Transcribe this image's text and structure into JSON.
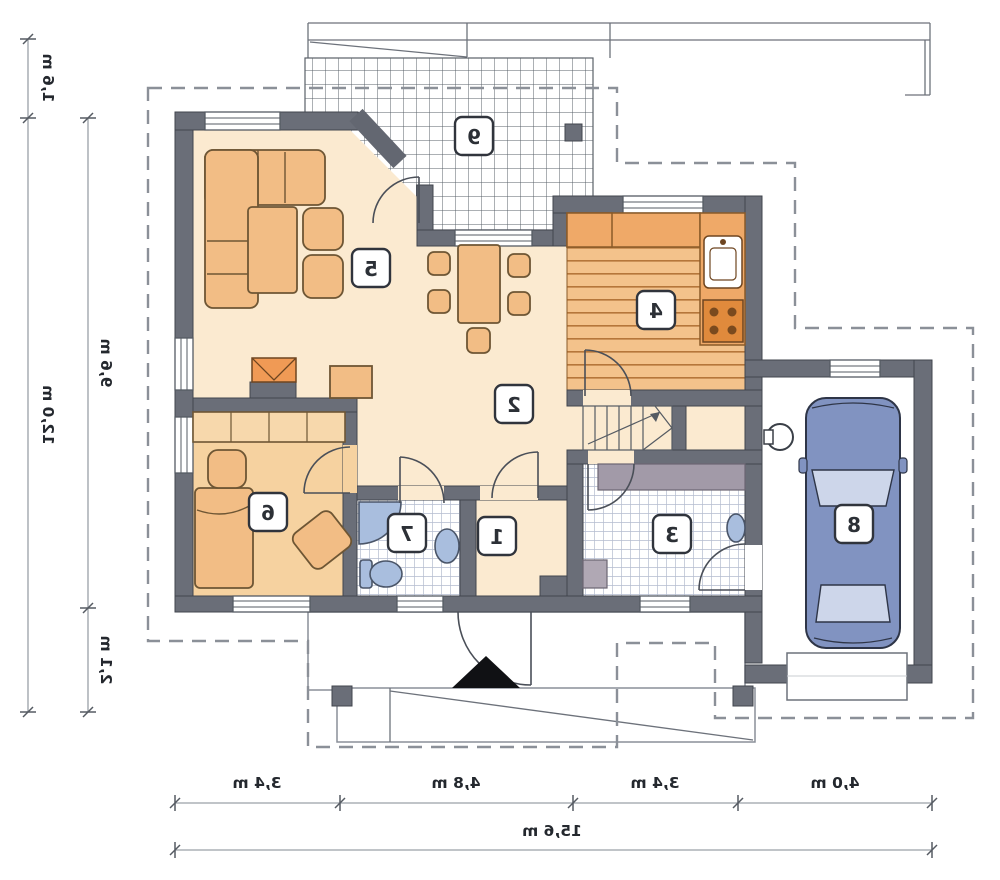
{
  "plan": {
    "rooms": [
      {
        "number": "1"
      },
      {
        "number": "2"
      },
      {
        "number": "3"
      },
      {
        "number": "4"
      },
      {
        "number": "5"
      },
      {
        "number": "6"
      },
      {
        "number": "7"
      },
      {
        "number": "8"
      },
      {
        "number": "9"
      }
    ],
    "dimensions": {
      "left": [
        {
          "label": "1,6 m"
        },
        {
          "label": "12,0 m"
        },
        {
          "label": "9,6 m"
        },
        {
          "label": "2,1 m"
        }
      ],
      "bottom": [
        {
          "label": "3,4 m"
        },
        {
          "label": "4,8 m"
        },
        {
          "label": "3,4 m"
        },
        {
          "label": "4,0 m"
        }
      ],
      "bottom_total": {
        "label": "15,6 m"
      }
    },
    "icons": {
      "entrance_arrow": "triangle-up"
    },
    "colors": {
      "wall": "#6a6e78",
      "floor_main": "#fbead0",
      "floor_bedroom": "#f6d2a0",
      "floor_wood": "#f3c28b",
      "counter": "#efa968",
      "furniture": "#f2bd85",
      "fixture_blue": "#a9bede",
      "car_body": "#8193c1",
      "dashed_outline": "#8b9098"
    }
  }
}
